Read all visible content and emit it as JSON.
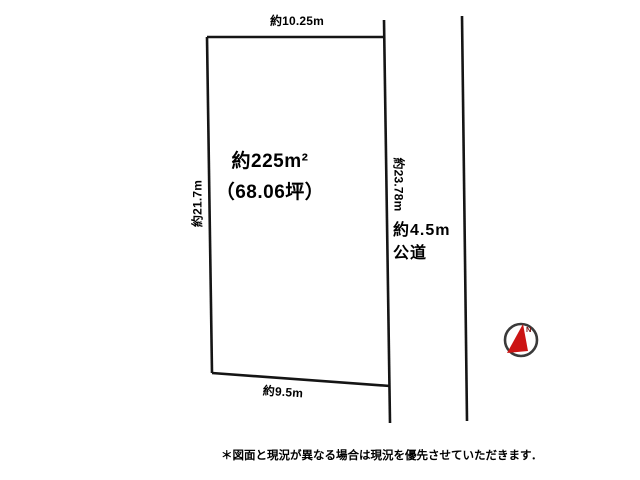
{
  "diagram": {
    "plot": {
      "top_width_label": "約10.25m",
      "left_height_label": "約21.7m",
      "right_height_label": "約23.78m",
      "bottom_width_label": "約9.5m",
      "area_label": "約225m²",
      "area_tsubo_label": "（68.06坪）"
    },
    "road": {
      "width_label": "約4.5m",
      "type_label": "公道"
    },
    "compass": {
      "north_label": "N"
    },
    "note_text": "＊図面と現況が異なる場合は現況を優先させていただきます．",
    "colors": {
      "line": "#151515",
      "text": "#000000",
      "compass_ring": "#3a3a3a",
      "compass_needle": "#cc1414",
      "compass_north": "#7a1010"
    }
  }
}
